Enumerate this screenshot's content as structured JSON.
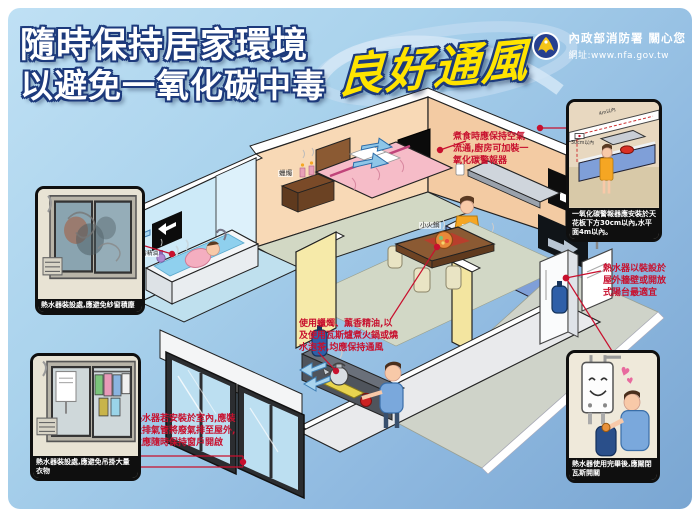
{
  "header": {
    "title_line1": "隨時保持居家環境",
    "title_line2": "以避免一氧化碳中毒",
    "highlight": "良好通風",
    "agency_name": "內政部消防署 關心您",
    "agency_url": "網址:www.nfa.gov.tw"
  },
  "callouts": {
    "kitchen_air": "煮食時應保持空氣流通,廚房可加裝一氧化碳警報器",
    "heater_outdoor": "熱水器以裝設於屋外牆壁或開放式陽台最適宜",
    "keep_ventilated": "使用蠟燭、薰香精油,以及使用瓦斯爐煮火鍋或燒水泡茶,均應保持通風",
    "heater_indoor": "熱水器若安裝於室內,應裝設排氣管將廢氣排至屋外,並應隨時保持窗戶開啟"
  },
  "insets": {
    "screen_dust": {
      "caption": "熱水器裝設處,應避免紗窗積塵"
    },
    "hanging_clothes": {
      "caption": "熱水器裝設處,應避免吊掛大量衣物"
    },
    "co_alarm": {
      "caption": "一氧化碳警報器應安裝於天花板下方30cm以內,水平面4m以內。",
      "label_4m": "4m以內",
      "label_30cm": "30cm以內"
    },
    "gas_off": {
      "caption": "熱水器使用完畢後,應關閉瓦斯開關"
    }
  },
  "scene_labels": {
    "candle": "蠟燭",
    "aroma_oil": "薰香精油",
    "hot_pot": "小火鍋"
  },
  "colors": {
    "background_top": "#bfe0f4",
    "background_bottom": "#7aa6d2",
    "title_text": "#ffffff",
    "highlight_text": "#ffe400",
    "callout_red": "#c8102e",
    "caption_bar": "#0f0f0f",
    "wall_peach": "#f8d9b6",
    "wall_blue": "#cdeaf8",
    "wall_yellow": "#f6eaa9"
  }
}
